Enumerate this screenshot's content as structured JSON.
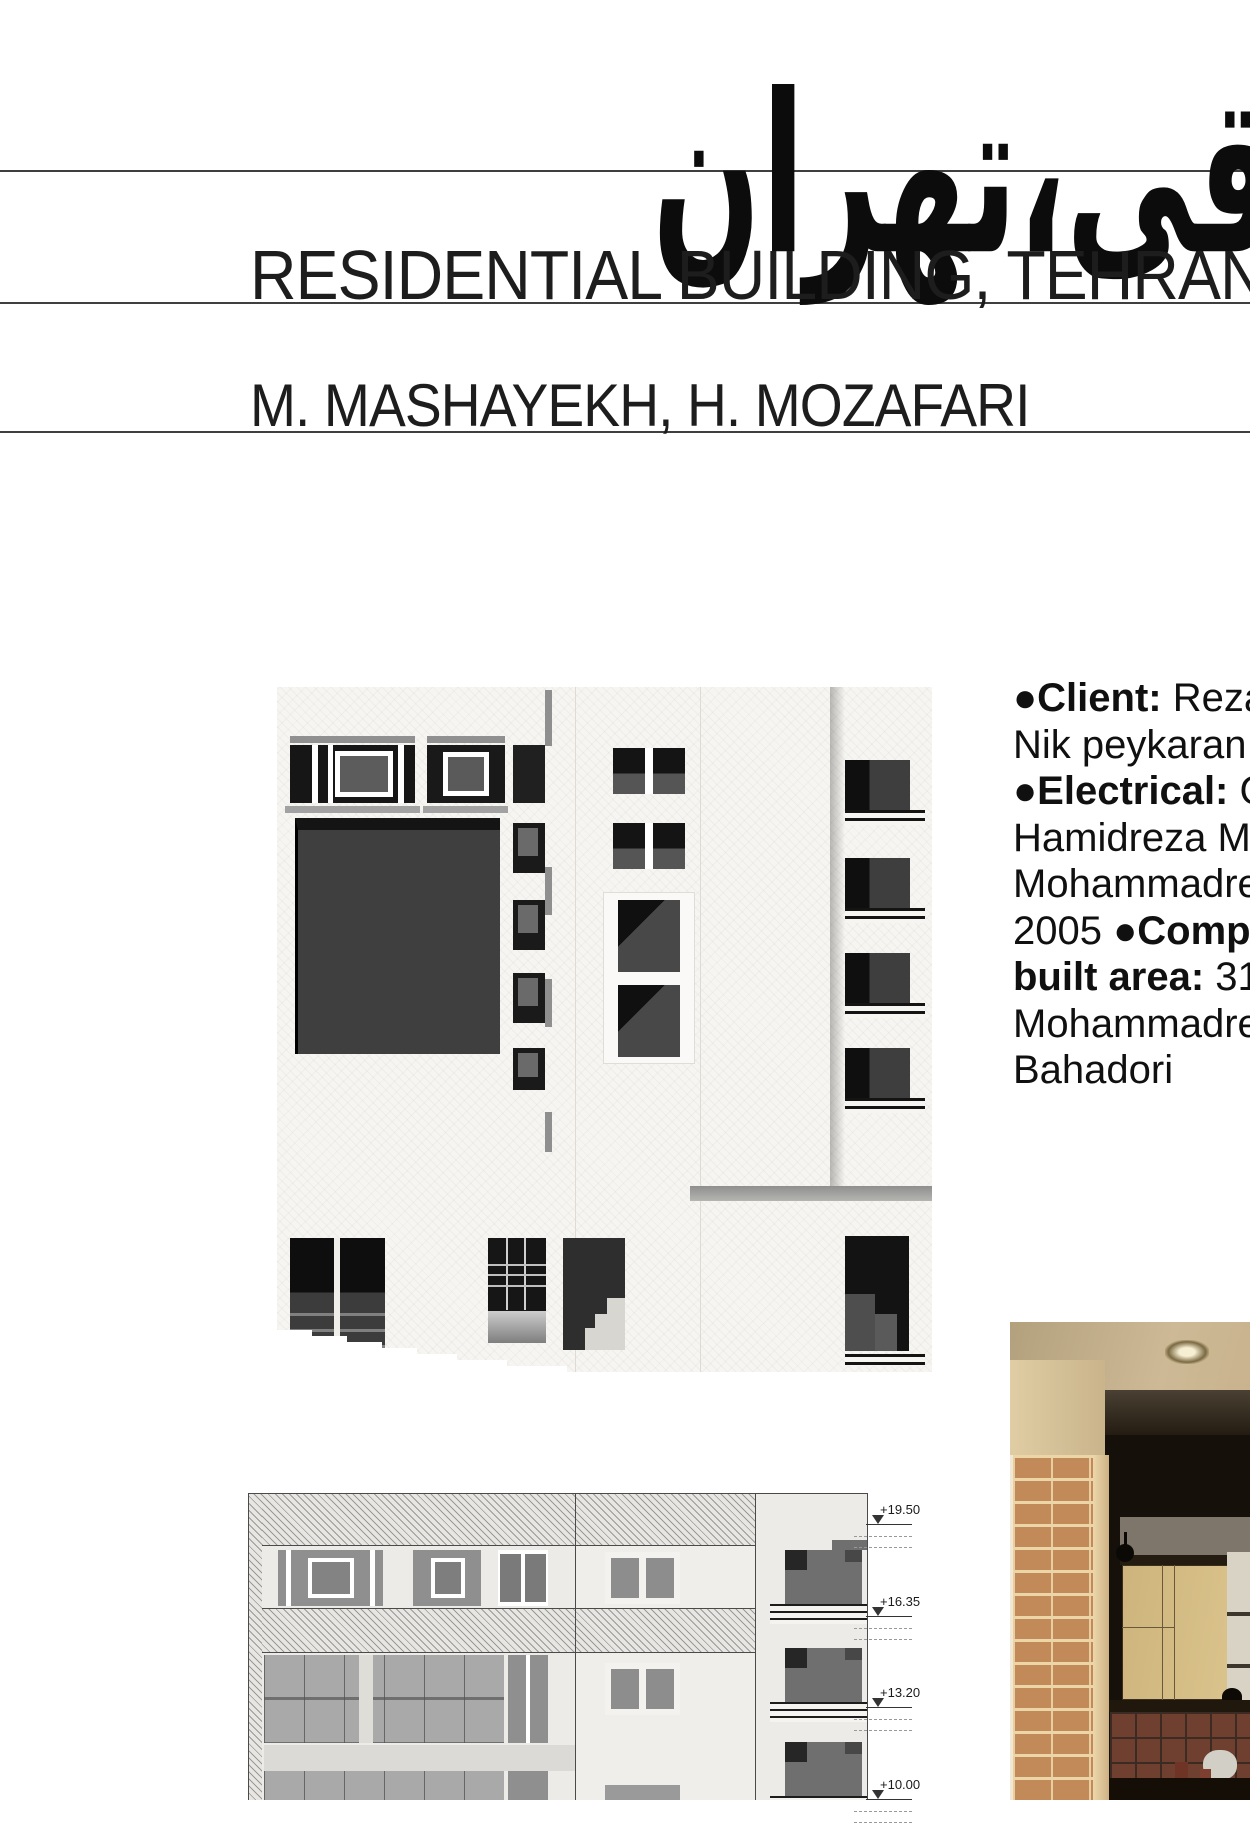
{
  "titles": {
    "persian": "عراقی،تهران",
    "english": "RESIDENTIAL BUILDING, TEHRAN",
    "architects": "M. MASHAYEKH, H. MOZAFARI"
  },
  "project_info": {
    "lines": [
      [
        {
          "t": "●Client: ",
          "b": true
        },
        {
          "t": "Reza",
          "b": false
        }
      ],
      [
        {
          "t": "Nik peykaran ",
          "b": false
        }
      ],
      [
        {
          "t": "●Electrical: ",
          "b": true
        },
        {
          "t": "G",
          "b": false
        }
      ],
      [
        {
          "t": "Hamidreza Mo",
          "b": false
        }
      ],
      [
        {
          "t": "Mohammadre",
          "b": false
        }
      ],
      [
        {
          "t": "2005 ",
          "b": false
        },
        {
          "t": "●Compl",
          "b": true
        }
      ],
      [
        {
          "t": "built area: ",
          "b": true
        },
        {
          "t": "31",
          "b": false
        }
      ],
      [
        {
          "t": "Mohammadre",
          "b": false
        }
      ],
      [
        {
          "t": "Bahadori",
          "b": false
        }
      ]
    ]
  },
  "drawing": {
    "levels": [
      {
        "label": "+19.50",
        "y": 1524
      },
      {
        "label": "+16.35",
        "y": 1616
      },
      {
        "label": "+13.20",
        "y": 1707
      },
      {
        "label": "+10.00",
        "y": 1799
      }
    ]
  },
  "images": {
    "facade_render": "building-elevation-render",
    "elevation_drawing": "building-elevation-drawing",
    "interior_photo": "kitchen-interior-photo"
  },
  "colors": {
    "line": "#3f3f3f",
    "brick": "#c28a58",
    "wood_cabinet": "#d5bc84",
    "tile": "#6f3f30"
  }
}
